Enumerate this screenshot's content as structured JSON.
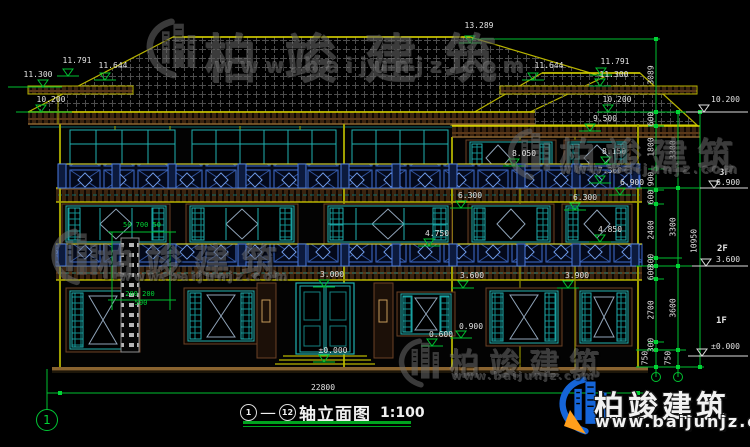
{
  "watermark": {
    "brand": "柏竣建筑",
    "site": "www.baijunjz.com"
  },
  "title_block": {
    "axis_start": "1",
    "axis_end": "12",
    "separator": "—",
    "name": "轴立面图",
    "scale": "1:100"
  },
  "axis_bubble": "1",
  "overall_width_dim": "22800",
  "markers": {
    "peak": "13.289",
    "left_roof": [
      "11.791",
      "11.644",
      "11.300",
      "10.200"
    ],
    "right_roof": [
      "11.644",
      "11.791",
      "11.300",
      "10.200"
    ],
    "facade": [
      "9.500",
      "8.050",
      "8.150",
      "7.360",
      "6.900",
      "6.300",
      "6.300",
      "4.850",
      "4.750",
      "3.000",
      "3.600",
      "3.900",
      "0.900",
      "0.600",
      "±0.000"
    ]
  },
  "right_margin": {
    "elev_top": "10.200",
    "floors": [
      {
        "label": "3F",
        "elev": "6.900"
      },
      {
        "label": "2F",
        "elev": "3.600"
      },
      {
        "label": "1F",
        "elev": "±0.000"
      }
    ]
  },
  "chains": {
    "inner": [
      "3089",
      "600",
      "1800",
      "900",
      "600",
      "2400",
      "300",
      "600",
      "2700",
      "300",
      "750"
    ],
    "mid": [
      "3300",
      "3300",
      "3600",
      "750"
    ],
    "outer": [
      "10950"
    ]
  },
  "detail_dims": {
    "chimney_top": "50 700 50",
    "chimney_mid": "200 200",
    "chimney_base": "500"
  }
}
